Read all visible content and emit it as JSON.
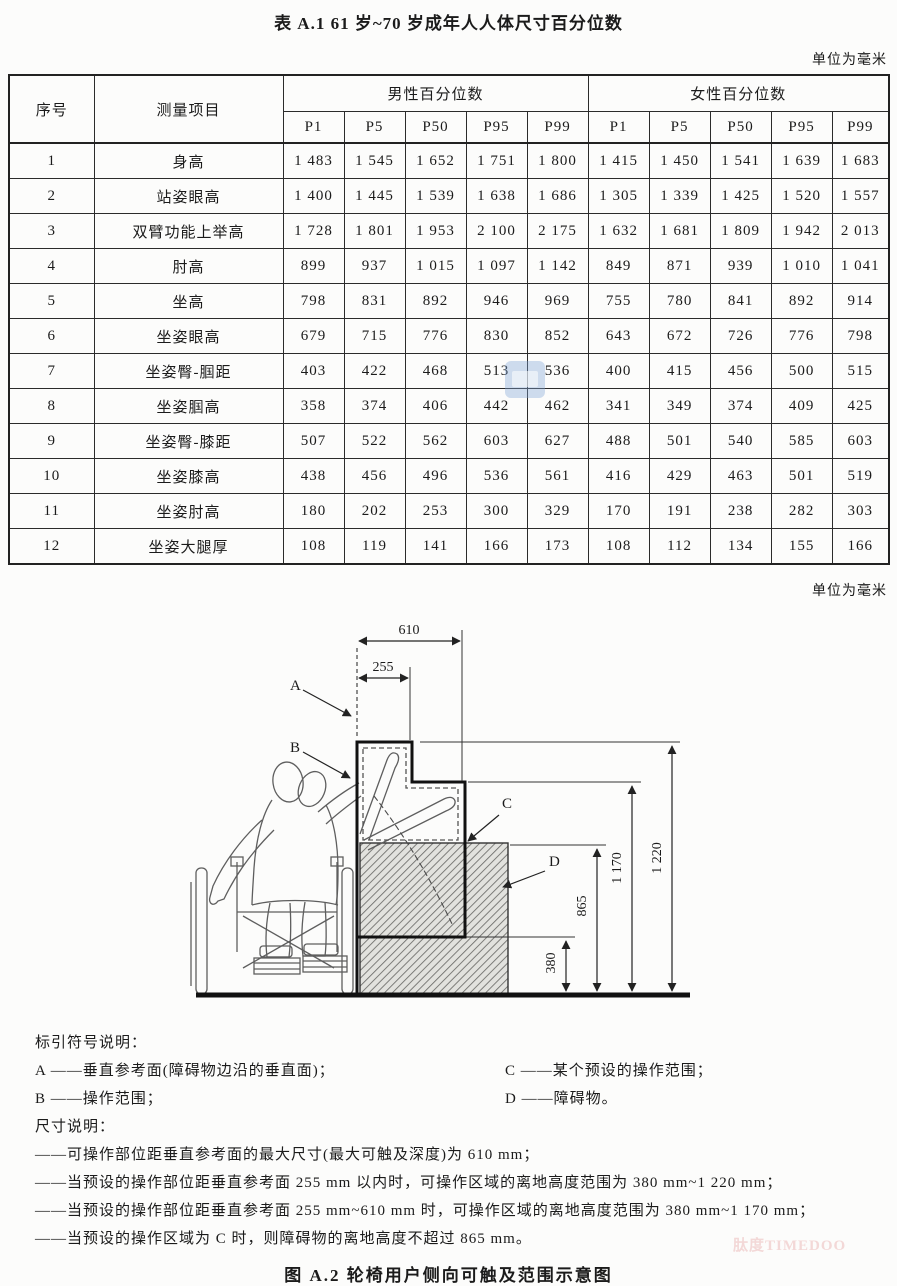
{
  "page": {
    "table_title": "表 A.1  61 岁~70 岁成年人人体尺寸百分位数",
    "unit_note_top": "单位为毫米",
    "unit_note_middle": "单位为毫米",
    "figure_caption": "图 A.2  轮椅用户侧向可触及范围示意图",
    "watermark_text": "肽度TIMEDOO"
  },
  "table": {
    "header_index": "序号",
    "header_item": "测量项目",
    "header_male_group": "男性百分位数",
    "header_female_group": "女性百分位数",
    "percentiles": [
      "P1",
      "P5",
      "P50",
      "P95",
      "P99"
    ],
    "rows": [
      {
        "no": "1",
        "item": "身高",
        "male": [
          "1 483",
          "1 545",
          "1 652",
          "1 751",
          "1 800"
        ],
        "female": [
          "1 415",
          "1 450",
          "1 541",
          "1 639",
          "1 683"
        ]
      },
      {
        "no": "2",
        "item": "站姿眼高",
        "male": [
          "1 400",
          "1 445",
          "1 539",
          "1 638",
          "1 686"
        ],
        "female": [
          "1 305",
          "1 339",
          "1 425",
          "1 520",
          "1 557"
        ]
      },
      {
        "no": "3",
        "item": "双臂功能上举高",
        "male": [
          "1 728",
          "1 801",
          "1 953",
          "2 100",
          "2 175"
        ],
        "female": [
          "1 632",
          "1 681",
          "1 809",
          "1 942",
          "2 013"
        ]
      },
      {
        "no": "4",
        "item": "肘高",
        "male": [
          "899",
          "937",
          "1 015",
          "1 097",
          "1 142"
        ],
        "female": [
          "849",
          "871",
          "939",
          "1 010",
          "1 041"
        ]
      },
      {
        "no": "5",
        "item": "坐高",
        "male": [
          "798",
          "831",
          "892",
          "946",
          "969"
        ],
        "female": [
          "755",
          "780",
          "841",
          "892",
          "914"
        ]
      },
      {
        "no": "6",
        "item": "坐姿眼高",
        "male": [
          "679",
          "715",
          "776",
          "830",
          "852"
        ],
        "female": [
          "643",
          "672",
          "726",
          "776",
          "798"
        ]
      },
      {
        "no": "7",
        "item": "坐姿臀-腘距",
        "male": [
          "403",
          "422",
          "468",
          "513",
          "536"
        ],
        "female": [
          "400",
          "415",
          "456",
          "500",
          "515"
        ]
      },
      {
        "no": "8",
        "item": "坐姿腘高",
        "male": [
          "358",
          "374",
          "406",
          "442",
          "462"
        ],
        "female": [
          "341",
          "349",
          "374",
          "409",
          "425"
        ]
      },
      {
        "no": "9",
        "item": "坐姿臀-膝距",
        "male": [
          "507",
          "522",
          "562",
          "603",
          "627"
        ],
        "female": [
          "488",
          "501",
          "540",
          "585",
          "603"
        ]
      },
      {
        "no": "10",
        "item": "坐姿膝高",
        "male": [
          "438",
          "456",
          "496",
          "536",
          "561"
        ],
        "female": [
          "416",
          "429",
          "463",
          "501",
          "519"
        ]
      },
      {
        "no": "11",
        "item": "坐姿肘高",
        "male": [
          "180",
          "202",
          "253",
          "300",
          "329"
        ],
        "female": [
          "170",
          "191",
          "238",
          "282",
          "303"
        ]
      },
      {
        "no": "12",
        "item": "坐姿大腿厚",
        "male": [
          "108",
          "119",
          "141",
          "166",
          "173"
        ],
        "female": [
          "108",
          "112",
          "134",
          "155",
          "166"
        ]
      }
    ]
  },
  "figure": {
    "labels": {
      "A": "A",
      "B": "B",
      "C": "C",
      "D": "D"
    },
    "dims": {
      "d610": "610",
      "d255": "255",
      "d1220": "1 220",
      "d1170": "1 170",
      "d865": "865",
      "d380": "380"
    }
  },
  "legend": {
    "symbols_heading": "标引符号说明：",
    "symbol_rows": [
      {
        "left": "A ——垂直参考面(障碍物边沿的垂直面)；",
        "right": "C ——某个预设的操作范围；"
      },
      {
        "left": "B ——操作范围；",
        "right": "D ——障碍物。"
      }
    ],
    "dims_heading": "尺寸说明：",
    "dim_notes": [
      "——可操作部位距垂直参考面的最大尺寸(最大可触及深度)为 610 mm；",
      "——当预设的操作部位距垂直参考面 255 mm 以内时，可操作区域的离地高度范围为 380 mm~1 220 mm；",
      "——当预设的操作部位距垂直参考面 255 mm~610 mm 时，可操作区域的离地高度范围为 380 mm~1 170 mm；",
      "——当预设的操作区域为 C 时，则障碍物的离地高度不超过 865 mm。"
    ]
  }
}
